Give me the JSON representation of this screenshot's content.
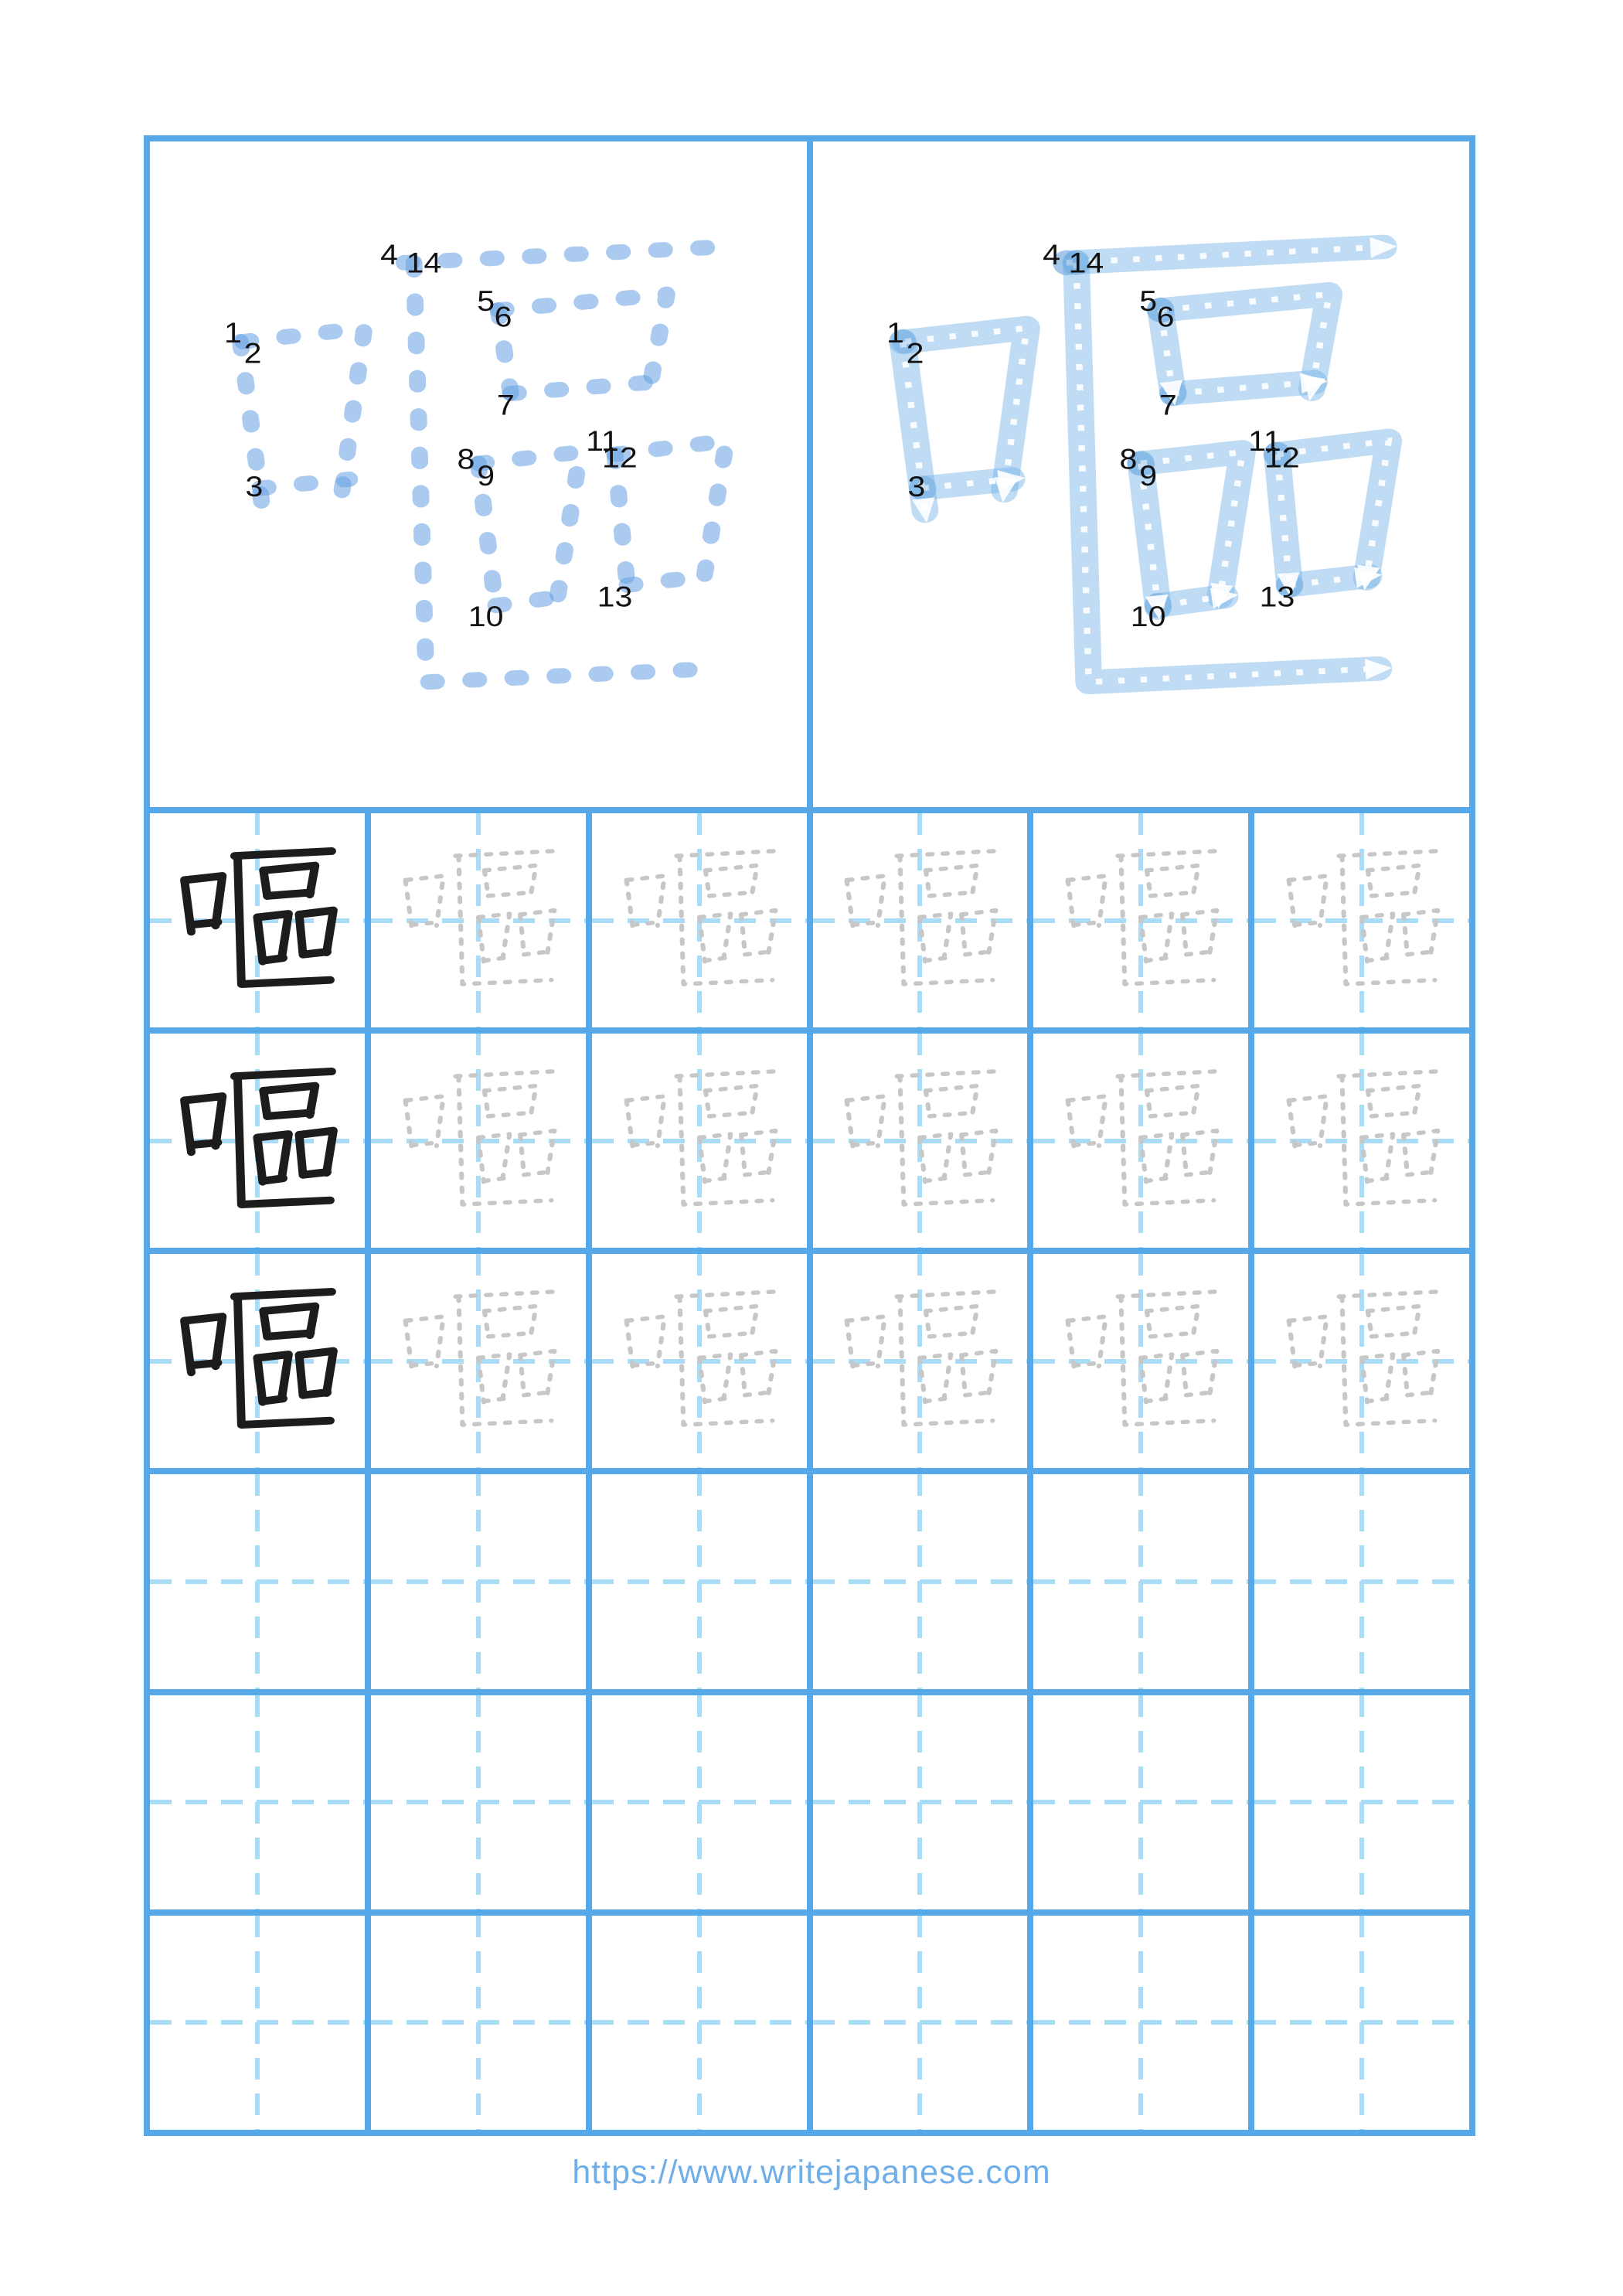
{
  "kanji": {
    "character": "嘔",
    "stroke_count": 14
  },
  "stroke_order": {
    "numbers": [
      "1",
      "2",
      "3",
      "4",
      "5",
      "6",
      "7",
      "8",
      "9",
      "10",
      "11",
      "12",
      "13",
      "14"
    ]
  },
  "practice_grid": {
    "rows": 6,
    "cols": 6,
    "kanji_rows": 3,
    "example_column": 1
  },
  "footer": {
    "url": "https://www.writejapanese.com"
  },
  "colors": {
    "border_blue": "#57A8E9",
    "guide_light_blue": "#A9DCF7",
    "stroke_dashed_blue": "#AACFEF",
    "stroke_thick_blue": "#C5DFF6",
    "trace_gray": "#C7C7C7",
    "ink_black": "#1C1C1C",
    "url_blue": "#6FAEE9"
  }
}
